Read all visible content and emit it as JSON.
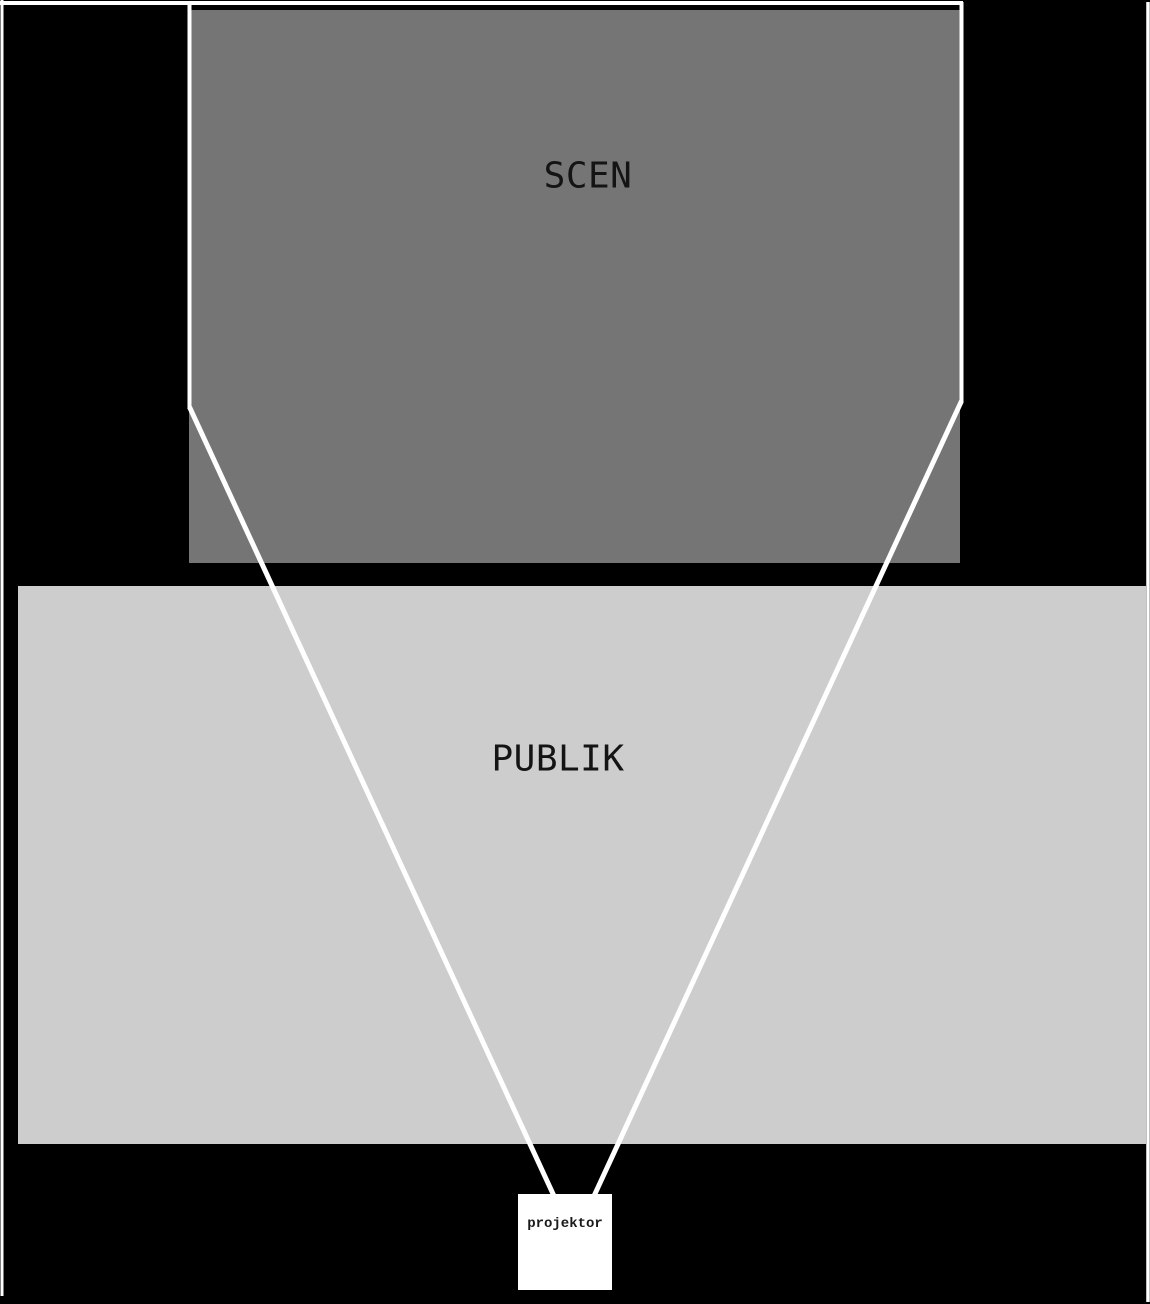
{
  "diagram": {
    "stage": {
      "label": "SCEN"
    },
    "audience": {
      "label": "PUBLIK"
    },
    "projector": {
      "label": "projektor"
    },
    "colors": {
      "background": "#000000",
      "stage_fill": "#757575",
      "audience_fill": "#cdcdcd",
      "projector_fill": "#ffffff",
      "line": "#ffffff",
      "label_text": "#141414",
      "projector_text": "#1a1a1a"
    }
  }
}
